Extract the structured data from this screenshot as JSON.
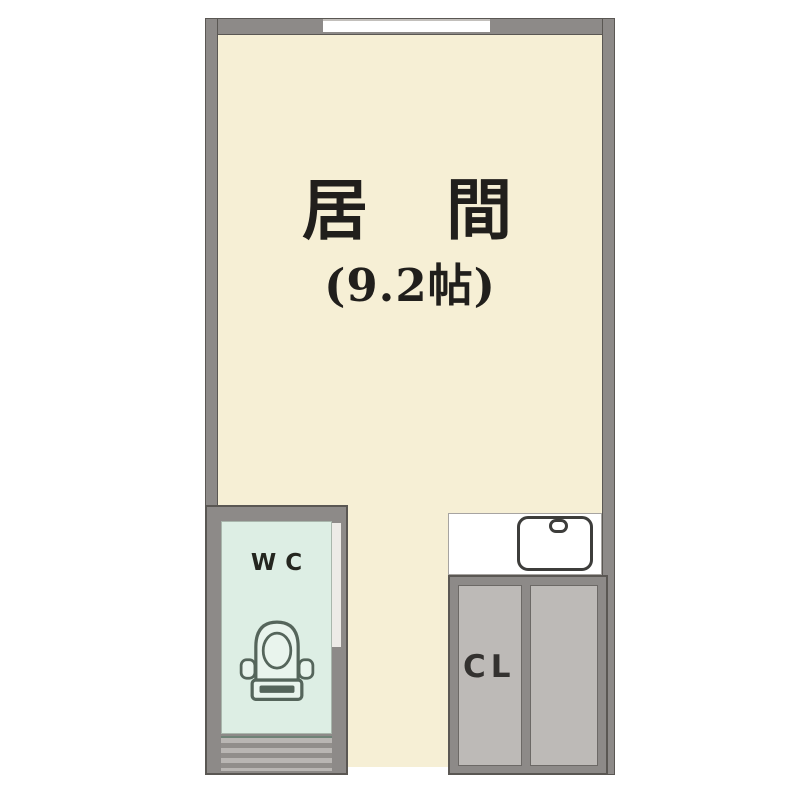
{
  "rooms": {
    "living": {
      "name": "居　間",
      "size": "(9.2帖)"
    },
    "wc": {
      "label": "WC"
    },
    "closet": {
      "label": "CL"
    }
  },
  "colors": {
    "background": "#ffffff",
    "floor": "#f6efd5",
    "wall": "#8d8a88",
    "wall_edge": "#5a5753",
    "wc_floor": "#ddeee4",
    "wc_fixture": "#55655b",
    "closet_door": "#bdbab7",
    "sink_outline": "#3d3d3b",
    "door_stripe_light": "#b9b6b3",
    "door_stripe_dark": "#918e8b",
    "text": "#211f1c"
  }
}
